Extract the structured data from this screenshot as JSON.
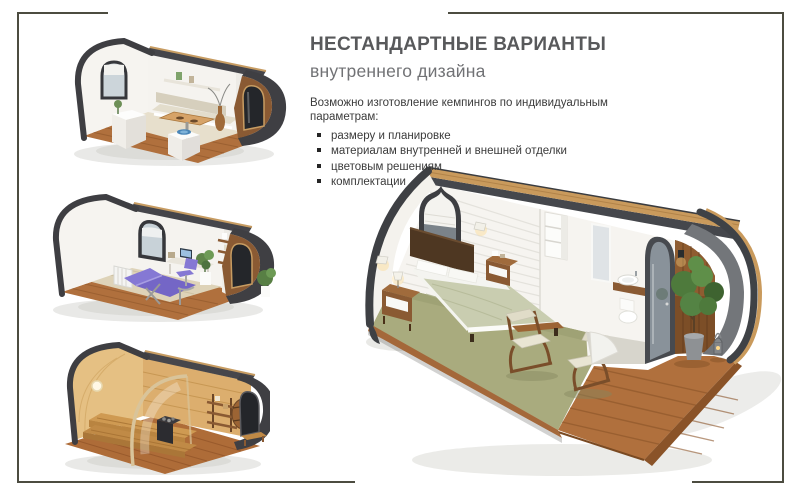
{
  "content": {
    "title": "НЕСТАНДАРТНЫЕ ВАРИАНТЫ",
    "subtitle": "внутреннего дизайна",
    "intro": "Возможно изготовление кемпингов по индивидуальным параметрам:",
    "bullets": [
      "размеру и планировке",
      "материалам внутренней и внешней отделки",
      "цветовым решениям",
      "комплектации"
    ]
  },
  "figures": {
    "top": "dining-pod",
    "middle": "massage-pod",
    "bottom": "sauna-pod",
    "main": "bedroom-pod"
  },
  "palette": {
    "frame_border": "#4c4c40",
    "title_text": "#58595b",
    "subtitle_text": "#717275",
    "body_text": "#3b3b3b",
    "shell_dark": "#414348",
    "wood_deck": "#b0703d",
    "wood_light": "#d9ab6c",
    "carpet_green": "#a9ab7e",
    "bedding_sage": "#c7cbae",
    "accent_purple": "#8074cf",
    "glass_gray": "#cbd4da"
  }
}
